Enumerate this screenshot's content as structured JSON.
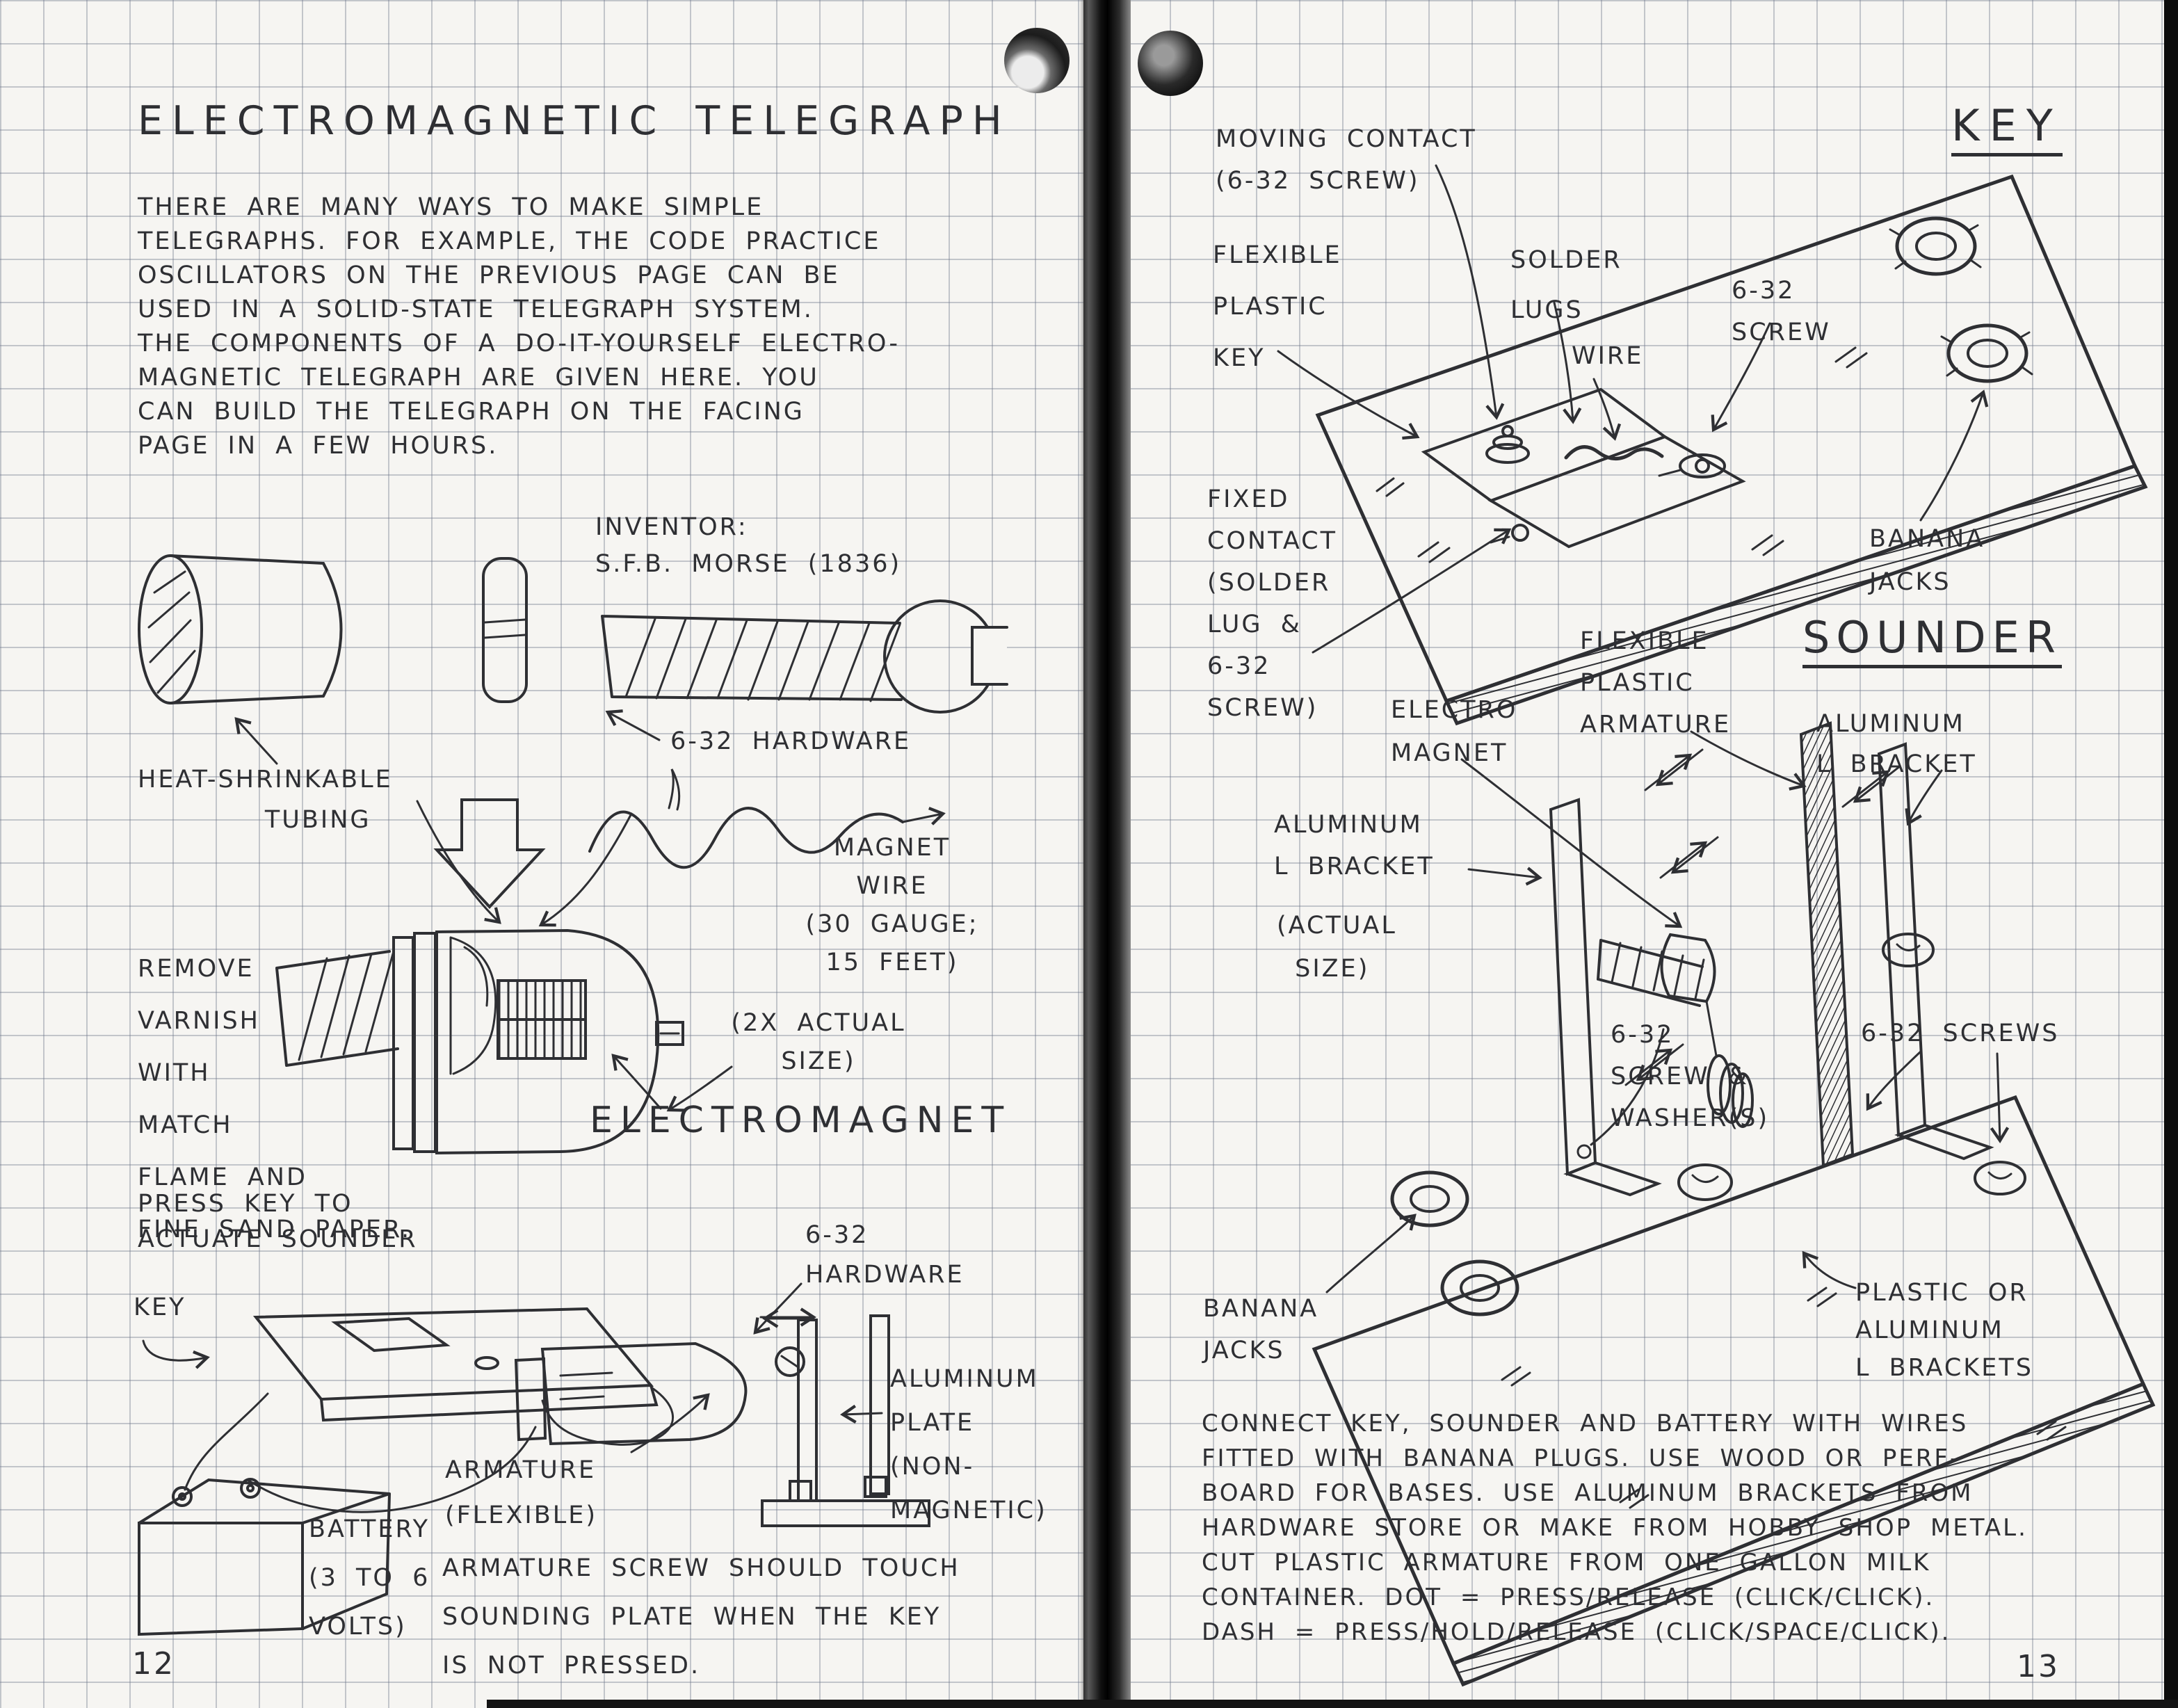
{
  "book": {
    "colors": {
      "paper": "#f6f5f2",
      "grid_line": "#6e768a",
      "ink": "#2e2f33"
    },
    "left": {
      "page_number": "12",
      "title": "ELECTROMAGNETIC TELEGRAPH",
      "intro": "THERE ARE MANY WAYS TO MAKE SIMPLE\nTELEGRAPHS. FOR EXAMPLE, THE CODE PRACTICE\nOSCILLATORS ON THE PREVIOUS PAGE CAN BE\nUSED IN A SOLID-STATE TELEGRAPH SYSTEM.\nTHE COMPONENTS OF A DO-IT-YOURSELF ELECTRO-\nMAGNETIC TELEGRAPH ARE GIVEN HERE. YOU\nCAN BUILD THE TELEGRAPH ON THE FACING\nPAGE IN A FEW HOURS.",
      "inventor_label": "INVENTOR:\nS.F.B. MORSE (1836)",
      "hardware_top_label": "6-32 HARDWARE",
      "tubing_label": "HEAT-SHRINKABLE\n       TUBING",
      "magnet_wire_label": "MAGNET\nWIRE\n(30 GAUGE;\n15 FEET)",
      "remove_varnish_label": "REMOVE\nVARNISH\nWITH\nMATCH\nFLAME AND\nFINE SAND PAPER.",
      "scale_label": "(2X ACTUAL\nSIZE)",
      "electromagnet_label": "ELECTROMAGNET",
      "press_key_label": "PRESS KEY TO\nACTUATE SOUNDER",
      "key_pointer_label": "KEY",
      "hardware_side_label": "6-32\nHARDWARE",
      "plate_label": "ALUMINUM\nPLATE\n(NON-\nMAGNETIC)",
      "armature_label": "ARMATURE\n(FLEXIBLE)",
      "battery_label": "BATTERY\n(3 TO 6\nVOLTS)",
      "note": "ARMATURE SCREW SHOULD TOUCH\nSOUNDING PLATE WHEN THE KEY\nIS NOT PRESSED."
    },
    "right": {
      "page_number": "13",
      "key_title": "KEY",
      "sounder_title": "SOUNDER",
      "moving_contact_label": "MOVING CONTACT\n(6-32 SCREW)",
      "flexible_key_label": "FLEXIBLE\nPLASTIC\nKEY",
      "solder_lugs_label": "SOLDER\nLUGS",
      "wire_label": "WIRE",
      "screw_label": "6-32\nSCREW",
      "banana_jacks_top_label": "BANANA\nJACKS",
      "fixed_contact_label": "FIXED\nCONTACT\n(SOLDER\nLUG &\n6-32\nSCREW)",
      "flexible_armature_label": "FLEXIBLE\nPLASTIC\nARMATURE",
      "electro_magnet_label": "ELECTRO\nMAGNET",
      "l_bracket_right_label": "ALUMINUM\nL BRACKET",
      "l_bracket_left_label": "ALUMINUM\nL BRACKET",
      "actual_size_label": "(ACTUAL\n SIZE)",
      "screw_washer_label": "6-32\nSCREW &\nWASHER(S)",
      "screws_label": "6-32 SCREWS",
      "banana_jacks_bottom_label": "BANANA\nJACKS",
      "brackets_label": "PLASTIC OR\nALUMINUM\nL BRACKETS",
      "outro": "CONNECT KEY, SOUNDER AND BATTERY WITH WIRES\nFITTED WITH BANANA PLUGS. USE WOOD OR PERF-\nBOARD FOR BASES. USE ALUMINUM BRACKETS FROM\nHARDWARE STORE OR MAKE FROM HOBBY SHOP METAL.\nCUT PLASTIC ARMATURE FROM ONE GALLON MILK\nCONTAINER. DOT = PRESS/RELEASE (CLICK/CLICK).\nDASH = PRESS/HOLD/RELEASE (CLICK/SPACE/CLICK)."
    }
  }
}
